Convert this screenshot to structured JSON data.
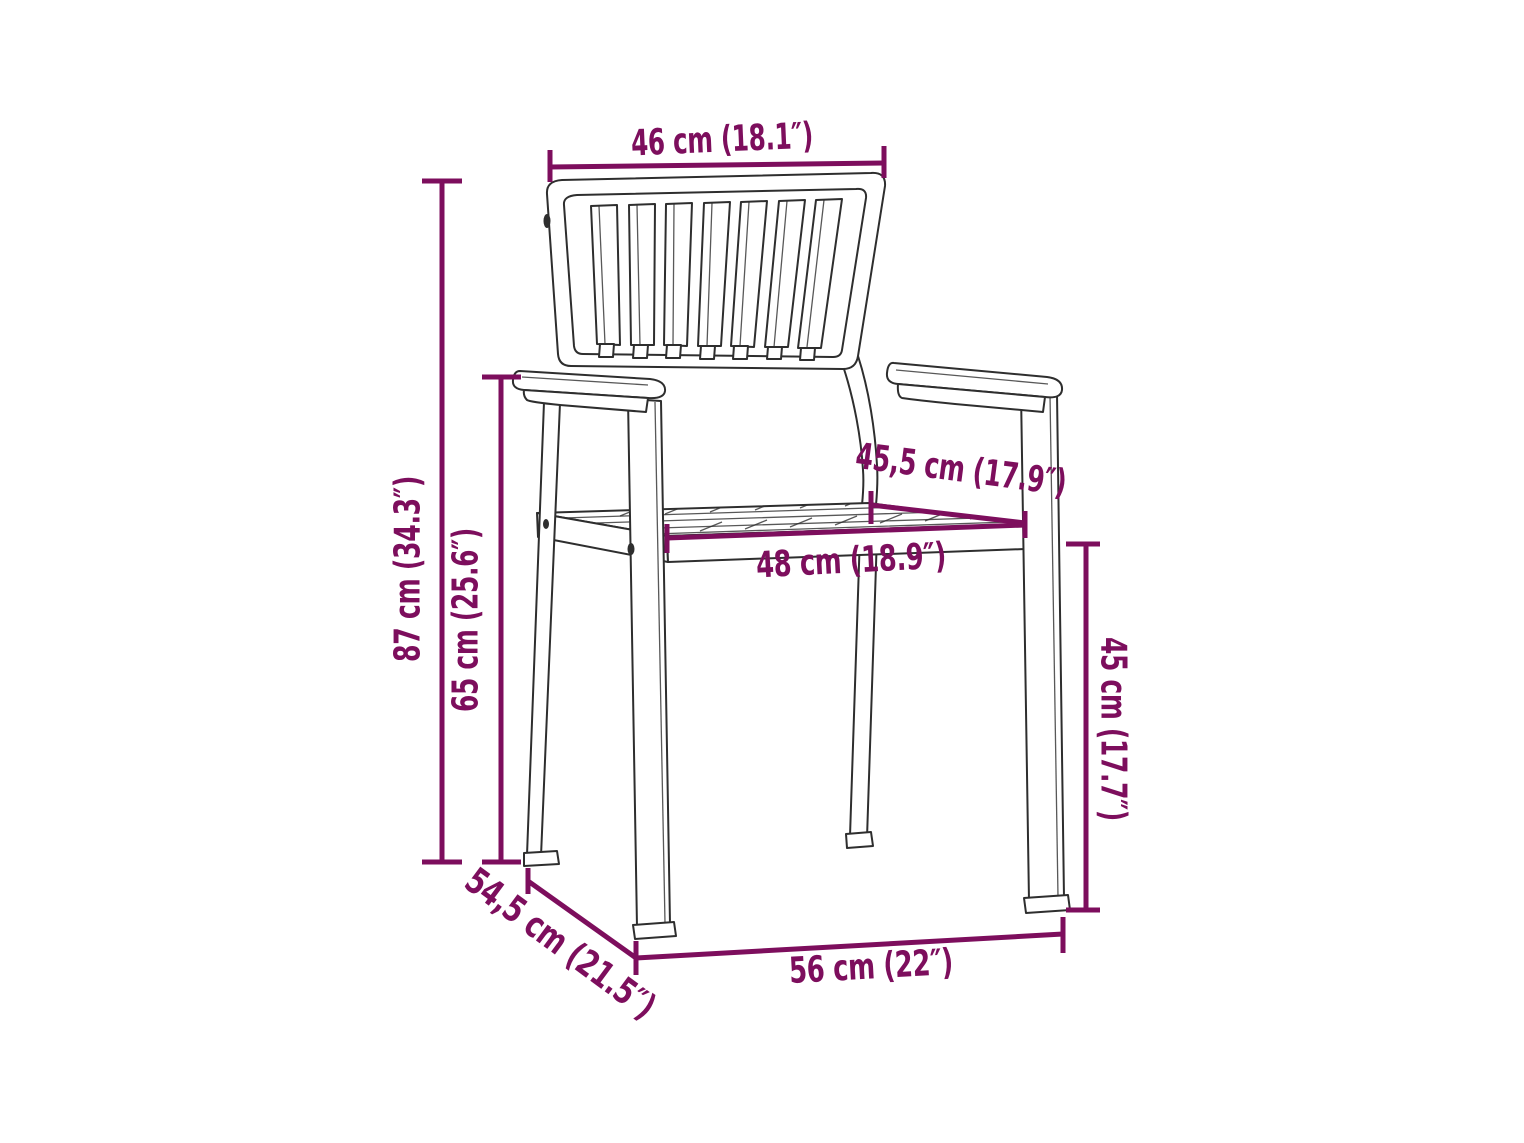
{
  "diagram": {
    "colors": {
      "artwork_line": "#2e2e2e",
      "dimension": "#7d0e5d",
      "background": "#ffffff"
    },
    "dims": {
      "backrest_width": {
        "label": "46 cm (18.1″)"
      },
      "total_height": {
        "label": "87 cm (34.3″)"
      },
      "armrest_height": {
        "label": "65 cm (25.6″)"
      },
      "seat_depth": {
        "label": "45,5 cm (17.9″)"
      },
      "seat_width": {
        "label": "48 cm (18.9″)"
      },
      "seat_height": {
        "label": "45 cm (17.7″)"
      },
      "floor_depth": {
        "label": "54,5 cm (21.5″)"
      },
      "floor_width": {
        "label": "56 cm (22″)"
      }
    }
  }
}
